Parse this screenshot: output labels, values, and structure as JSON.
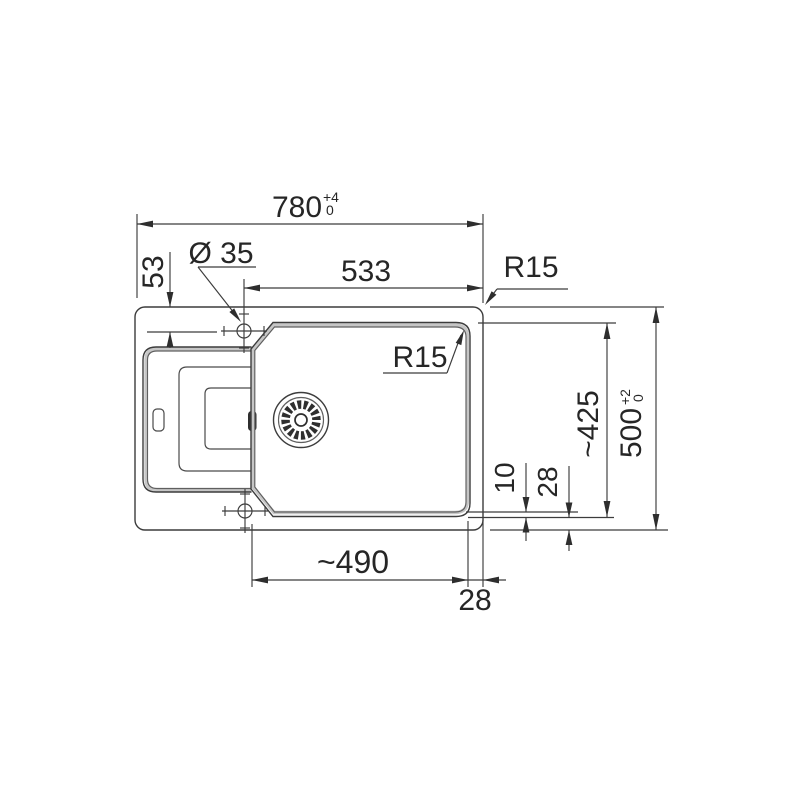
{
  "page": {
    "background": "#ffffff"
  },
  "drawing": {
    "dims": {
      "overall_width": {
        "value": "780",
        "tol_plus": "+4",
        "tol_minus": "0"
      },
      "overall_depth": {
        "value": "500",
        "tol_plus": "+2",
        "tol_minus": "0"
      },
      "bowl_width": "533",
      "bowl_depth": "~425",
      "bowl_bottom_width": "~490",
      "tap_hole_diameter": "Ø 35",
      "tap_hole_offset": "53",
      "corner_radius_outer": "R15",
      "corner_radius_bowl": "R15",
      "hole_to_bowl_edge": "10",
      "rim_bottom": "28",
      "rim_right": "28"
    },
    "colors": {
      "line": "#3c3c3c",
      "text": "#262626",
      "edge_band": "#c6c6c6",
      "inner_line": "#5f5f5f",
      "background": "#ffffff"
    }
  }
}
